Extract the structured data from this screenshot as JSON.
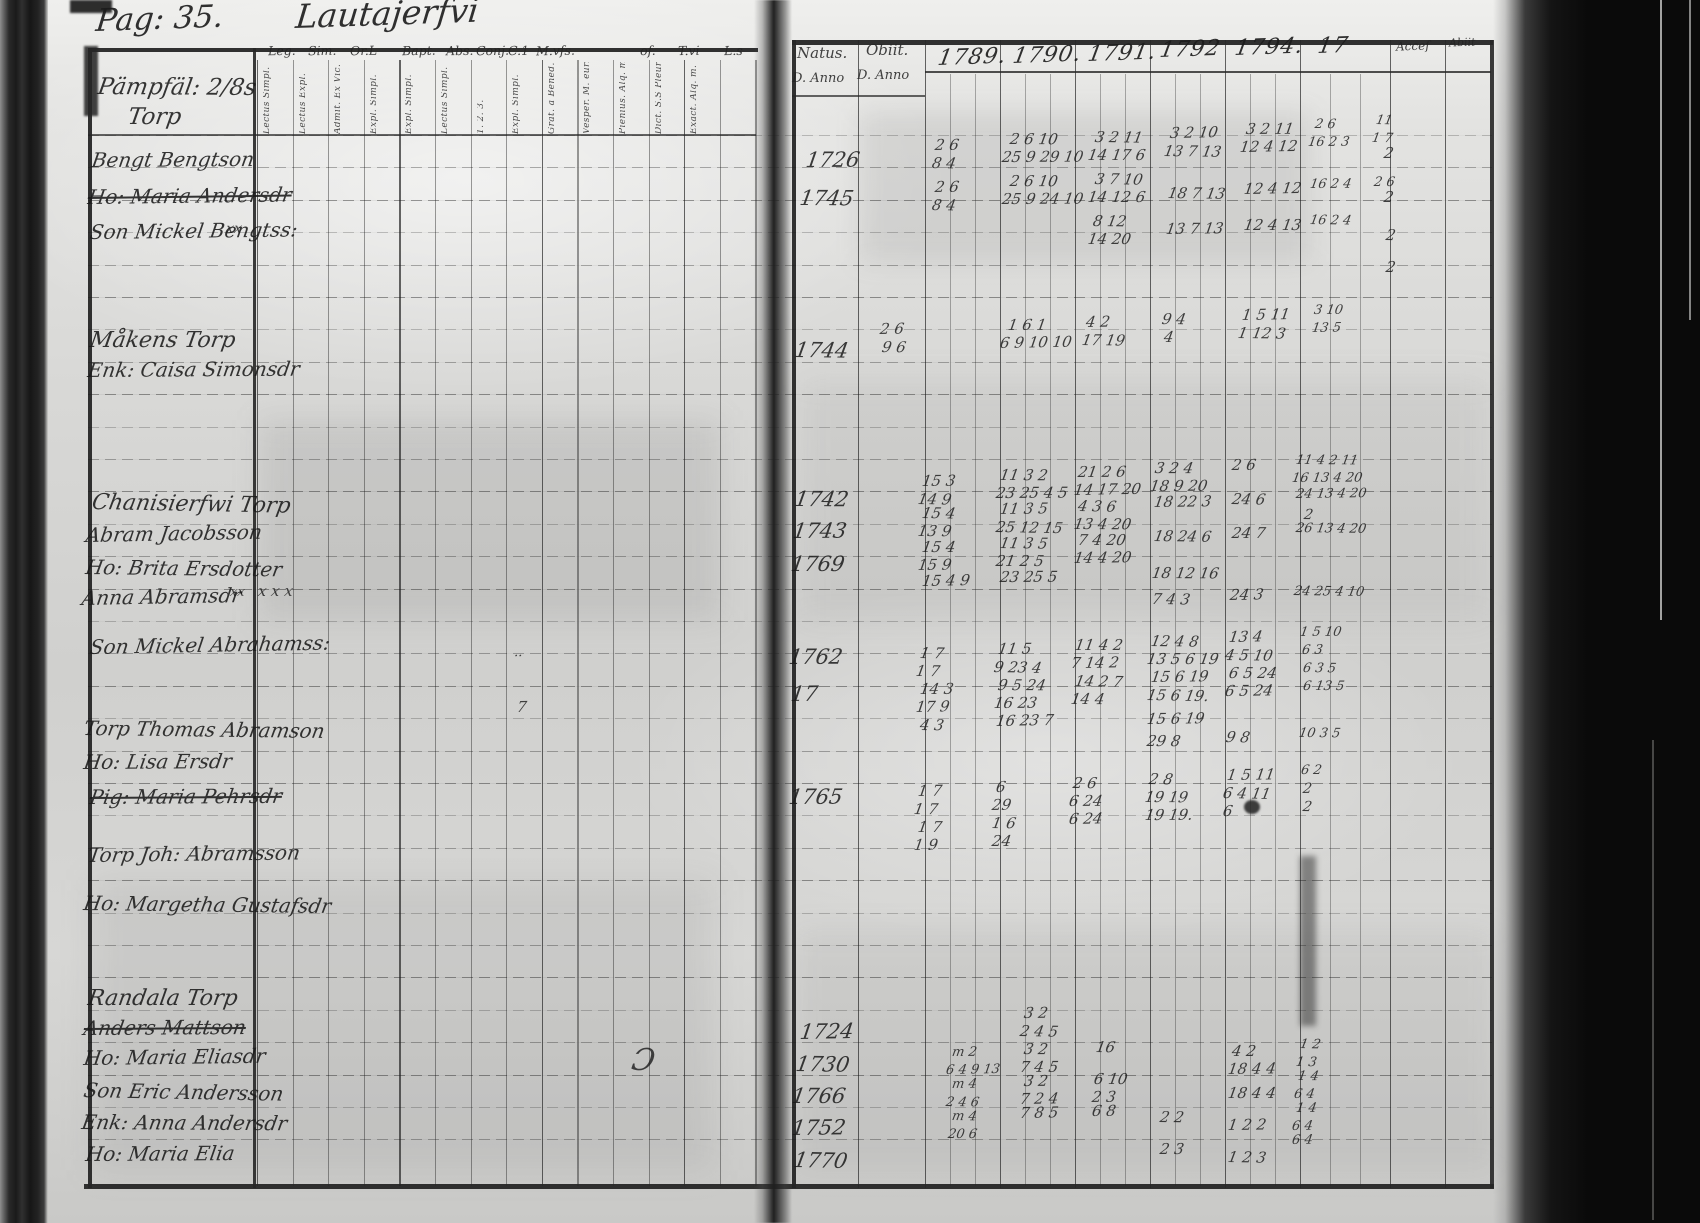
{
  "titles": {
    "page_label": "Pag: 35.",
    "book_title": "Lautajerfvi"
  },
  "ink_color": "#1b1b1b",
  "left_page": {
    "column_groups": [
      {
        "label": "Leg.",
        "x": 268
      },
      {
        "label": "Sim.",
        "x": 308
      },
      {
        "label": "Or.L",
        "x": 350
      },
      {
        "label": "Bapt.",
        "x": 402
      },
      {
        "label": "Abs.",
        "x": 446
      },
      {
        "label": "Conj.",
        "x": 476
      },
      {
        "label": "C.1",
        "x": 508
      },
      {
        "label": "M.vfs.",
        "x": 536
      },
      {
        "label": "of.",
        "x": 640
      },
      {
        "label": "T.vi",
        "x": 678
      },
      {
        "label": "L.s",
        "x": 724
      }
    ],
    "column_subheaders": [
      "Lectus Simpl.",
      "Lectus Expl.",
      "Admit. Ex Vic.",
      "Expl. Simpl.",
      "Expl. Simpl.",
      "Lectus Simpl.",
      "1. 2. 3.",
      "Expl. Simpl.",
      "Grat. a Bened.",
      "Vesper. M. eur.",
      "Pienius. Alq. m.",
      "Dict. S.S Pleuris.",
      "Exact. Alq. m.",
      ""
    ],
    "entries": [
      {
        "text": "Pämpfäl: 2/8s",
        "x": 98,
        "y": 76,
        "size": 23
      },
      {
        "text": "Torp",
        "x": 128,
        "y": 106,
        "size": 23
      },
      {
        "text": "Bengt Bengtson",
        "x": 92,
        "y": 150,
        "size": 20
      },
      {
        "text": "Ho: Maria Andersdr",
        "x": 88,
        "y": 187,
        "size": 20,
        "struck": true
      },
      {
        "text": "Son Mickel Bengtss:",
        "x": 90,
        "y": 222,
        "size": 20
      },
      {
        "text": "Måkens Torp",
        "x": 90,
        "y": 330,
        "size": 22
      },
      {
        "text": "Enk: Caisa Simonsdr",
        "x": 88,
        "y": 360,
        "size": 20
      },
      {
        "text": "Chanisierfwi Torp",
        "x": 92,
        "y": 492,
        "size": 22
      },
      {
        "text": "Abram Jacobsson",
        "x": 86,
        "y": 525,
        "size": 20
      },
      {
        "text": "Ho: Brita Ersdotter",
        "x": 86,
        "y": 557,
        "size": 20
      },
      {
        "text": "Anna Abramsdr",
        "x": 82,
        "y": 588,
        "size": 20
      },
      {
        "text": "Son Mickel Abrahamss:",
        "x": 90,
        "y": 637,
        "size": 20
      },
      {
        "text": "Torp Thomas Abramson",
        "x": 84,
        "y": 718,
        "size": 20
      },
      {
        "text": "Ho: Lisa Ersdr",
        "x": 84,
        "y": 752,
        "size": 20
      },
      {
        "text": "Pig: Maria Pehrsdr",
        "x": 90,
        "y": 787,
        "size": 20,
        "struck": true
      },
      {
        "text": "Torp Joh: Abramsson",
        "x": 88,
        "y": 845,
        "size": 20
      },
      {
        "text": "Ho: Margetha Gustafsdr",
        "x": 84,
        "y": 893,
        "size": 20
      },
      {
        "text": "Randala Torp",
        "x": 88,
        "y": 988,
        "size": 22
      },
      {
        "text": "Anders Mattson",
        "x": 84,
        "y": 1018,
        "size": 20,
        "struck": true
      },
      {
        "text": "Ho: Maria Eliasdr",
        "x": 84,
        "y": 1048,
        "size": 20
      },
      {
        "text": "Son Eric Andersson",
        "x": 84,
        "y": 1080,
        "size": 20
      },
      {
        "text": "Enk: Anna Andersdr",
        "x": 82,
        "y": 1112,
        "size": 20
      },
      {
        "text": "Ho: Maria Elia",
        "x": 86,
        "y": 1144,
        "size": 20
      }
    ],
    "misc_marks": [
      [
        226,
        222,
        "xx",
        14
      ],
      [
        230,
        586,
        "xx",
        13
      ],
      [
        258,
        584,
        "x x x",
        15
      ],
      [
        514,
        650,
        "··",
        13
      ],
      [
        517,
        700,
        "7",
        15
      ],
      [
        632,
        1046,
        "Ɔ",
        30
      ]
    ]
  },
  "right_page": {
    "natus_label": "Natus.",
    "obiit_label": "Obiit.",
    "anno_label": "D. Anno",
    "anno_label2": "D. Anno",
    "accessit_label": "Acceſ",
    "abiit_label": "Abiit",
    "year_headers": [
      {
        "label": "1789.",
        "x": 938,
        "y": 48
      },
      {
        "label": "1790.",
        "x": 1013,
        "y": 46
      },
      {
        "label": "1791.",
        "x": 1088,
        "y": 44
      },
      {
        "label": "1792",
        "x": 1160,
        "y": 40
      },
      {
        "label": "1794.",
        "x": 1235,
        "y": 38
      },
      {
        "label": "17",
        "x": 1318,
        "y": 36
      }
    ],
    "natus_years": [
      [
        806,
        150,
        "1726"
      ],
      [
        800,
        188,
        "1745"
      ],
      [
        795,
        340,
        "1744"
      ],
      [
        795,
        489,
        "1742"
      ],
      [
        793,
        521,
        "1743"
      ],
      [
        791,
        554,
        "1769"
      ],
      [
        789,
        647,
        "1762"
      ],
      [
        791,
        684,
        "17"
      ],
      [
        789,
        787,
        "1765"
      ],
      [
        800,
        1022,
        "1724"
      ],
      [
        796,
        1054,
        "1730"
      ],
      [
        792,
        1086,
        "1766"
      ],
      [
        792,
        1118,
        "1752"
      ],
      [
        794,
        1150,
        "1770"
      ]
    ],
    "ink_marks": [
      [
        935,
        138,
        "2 6"
      ],
      [
        932,
        156,
        "8 4"
      ],
      [
        1010,
        132,
        "2 6 10"
      ],
      [
        1002,
        150,
        "25 9 29 10"
      ],
      [
        1095,
        130,
        "3 2 11"
      ],
      [
        1088,
        148,
        "14 17 6"
      ],
      [
        1170,
        126,
        "3 2 10"
      ],
      [
        1164,
        144,
        "13 7 13"
      ],
      [
        1246,
        122,
        "3 2 11"
      ],
      [
        1240,
        140,
        "12 4 12"
      ],
      [
        1315,
        118,
        "2 6",
        13
      ],
      [
        1308,
        136,
        "16 2 3",
        13
      ],
      [
        1376,
        114,
        "11",
        13
      ],
      [
        1372,
        132,
        "1 7",
        13
      ],
      [
        935,
        180,
        "2 6"
      ],
      [
        932,
        198,
        "8 4"
      ],
      [
        1010,
        174,
        "2 6 10"
      ],
      [
        1002,
        192,
        "25 9 24 10"
      ],
      [
        1095,
        172,
        "3 7 10"
      ],
      [
        1088,
        190,
        "14 12 6"
      ],
      [
        1168,
        186,
        "18 7 13"
      ],
      [
        1244,
        182,
        "12 4 12"
      ],
      [
        1310,
        178,
        "16 2 4",
        13
      ],
      [
        1374,
        176,
        "2 6",
        13
      ],
      [
        1093,
        214,
        "8 12"
      ],
      [
        1088,
        232,
        "14 20"
      ],
      [
        1166,
        222,
        "13 7 13"
      ],
      [
        1244,
        218,
        "12 4 13"
      ],
      [
        1310,
        214,
        "16 2 4",
        13
      ],
      [
        1384,
        146,
        "2",
        15
      ],
      [
        1384,
        190,
        "2",
        15
      ],
      [
        1386,
        228,
        "2",
        15
      ],
      [
        1386,
        260,
        "2",
        15
      ],
      [
        880,
        322,
        "2 6"
      ],
      [
        882,
        340,
        "9 6"
      ],
      [
        1008,
        318,
        "1 6 1"
      ],
      [
        1000,
        336,
        "6 9 10 10"
      ],
      [
        1086,
        315,
        "4 2"
      ],
      [
        1082,
        333,
        "17 19"
      ],
      [
        1162,
        312,
        "9 4"
      ],
      [
        1164,
        330,
        "4"
      ],
      [
        1242,
        308,
        "1 5 11"
      ],
      [
        1238,
        326,
        "1 12 3"
      ],
      [
        1314,
        304,
        "3 10",
        13
      ],
      [
        1312,
        322,
        "13 5",
        13
      ],
      [
        922,
        474,
        "15 3"
      ],
      [
        918,
        492,
        "14 9"
      ],
      [
        1000,
        468,
        "11 3 2"
      ],
      [
        996,
        486,
        "23 25 4 5"
      ],
      [
        1078,
        465,
        "21 2 6"
      ],
      [
        1074,
        483,
        "14 17 20"
      ],
      [
        1155,
        461,
        "3 2 4"
      ],
      [
        1150,
        479,
        "18 9 20"
      ],
      [
        1232,
        458,
        "2 6"
      ],
      [
        1296,
        454,
        "11 4 2 11",
        13
      ],
      [
        1292,
        472,
        "16 13 4 20",
        13
      ],
      [
        922,
        506,
        "15 4"
      ],
      [
        918,
        524,
        "13 9"
      ],
      [
        1000,
        502,
        "11 3 5"
      ],
      [
        996,
        520,
        "25 12 15"
      ],
      [
        1078,
        499,
        "4 3 6"
      ],
      [
        1074,
        517,
        "13 4 20"
      ],
      [
        1154,
        495,
        "18 22 3"
      ],
      [
        1232,
        492,
        "24 6"
      ],
      [
        1296,
        488,
        "24 13 4 20",
        13
      ],
      [
        1304,
        508,
        "2",
        14
      ],
      [
        922,
        540,
        "15 4"
      ],
      [
        918,
        558,
        "15 9"
      ],
      [
        1000,
        536,
        "11 3 5"
      ],
      [
        996,
        554,
        "21 2 5"
      ],
      [
        1078,
        533,
        "7 4 20"
      ],
      [
        1074,
        551,
        "14 4 20"
      ],
      [
        1154,
        529,
        "18 24 6"
      ],
      [
        1232,
        526,
        "24 7"
      ],
      [
        1296,
        522,
        "26 13 4 20",
        13
      ],
      [
        922,
        574,
        "15 4 9"
      ],
      [
        1000,
        570,
        "23 25 5"
      ],
      [
        1152,
        566,
        "18 12 16"
      ],
      [
        1152,
        592,
        "7 4 3"
      ],
      [
        1230,
        588,
        "24 3"
      ],
      [
        1294,
        585,
        "24 25 4 10",
        13
      ],
      [
        920,
        646,
        "1 7"
      ],
      [
        916,
        664,
        "1 7"
      ],
      [
        998,
        642,
        "11 5"
      ],
      [
        994,
        660,
        "9 23 4"
      ],
      [
        1075,
        638,
        "11 4 2"
      ],
      [
        1071,
        656,
        "7 14 2"
      ],
      [
        1151,
        634,
        "12 4 8"
      ],
      [
        1147,
        652,
        "13 5 6 19"
      ],
      [
        1229,
        630,
        "13 4"
      ],
      [
        1225,
        648,
        "4 5 10"
      ],
      [
        1300,
        626,
        "1 5 10",
        13
      ],
      [
        1302,
        644,
        "6 3",
        13
      ],
      [
        920,
        682,
        "14 3"
      ],
      [
        916,
        700,
        "17 9"
      ],
      [
        998,
        678,
        "9 5 24"
      ],
      [
        994,
        696,
        "16 23"
      ],
      [
        1075,
        674,
        "14 2 7"
      ],
      [
        1071,
        692,
        "14 4"
      ],
      [
        1151,
        670,
        "15 6 19"
      ],
      [
        1147,
        688,
        "15 6 19."
      ],
      [
        1229,
        666,
        "6 5 24"
      ],
      [
        1225,
        684,
        "6 5 24"
      ],
      [
        1303,
        662,
        "6 3 5",
        13
      ],
      [
        1303,
        680,
        "6 13 5",
        13
      ],
      [
        920,
        718,
        "4 3"
      ],
      [
        996,
        714,
        "16 23 7"
      ],
      [
        1147,
        712,
        "15 6 19"
      ],
      [
        1147,
        734,
        "29 8"
      ],
      [
        1226,
        730,
        "9 8"
      ],
      [
        1299,
        727,
        "10 3 5",
        13
      ],
      [
        918,
        784,
        "1 7"
      ],
      [
        914,
        802,
        "1 7"
      ],
      [
        996,
        780,
        "6"
      ],
      [
        992,
        798,
        "29"
      ],
      [
        1073,
        776,
        "2 6"
      ],
      [
        1069,
        794,
        "6 24"
      ],
      [
        1149,
        772,
        "2 8"
      ],
      [
        1145,
        790,
        "19 19"
      ],
      [
        1227,
        768,
        "1 5 11"
      ],
      [
        1223,
        786,
        "6 4 11"
      ],
      [
        1301,
        764,
        "6 2",
        13
      ],
      [
        1303,
        782,
        "2",
        14
      ],
      [
        918,
        820,
        "1 7"
      ],
      [
        992,
        816,
        "1 6"
      ],
      [
        1069,
        812,
        "6 24"
      ],
      [
        1145,
        808,
        "19 19."
      ],
      [
        1223,
        804,
        "6"
      ],
      [
        1303,
        800,
        "2",
        14
      ],
      [
        914,
        838,
        "1 9"
      ],
      [
        992,
        834,
        "24"
      ],
      [
        1024,
        1006,
        "3 2"
      ],
      [
        1020,
        1024,
        "2 4 5"
      ],
      [
        952,
        1046,
        "m 2",
        13
      ],
      [
        946,
        1064,
        "6 4 9 13",
        13
      ],
      [
        1024,
        1042,
        "3 2"
      ],
      [
        1020,
        1060,
        "7 4 5"
      ],
      [
        1096,
        1040,
        "16"
      ],
      [
        1232,
        1044,
        "4 2"
      ],
      [
        1228,
        1062,
        "18 4 4"
      ],
      [
        1300,
        1038,
        "1 2",
        13
      ],
      [
        1296,
        1056,
        "1 3",
        13
      ],
      [
        952,
        1078,
        "m 4",
        13
      ],
      [
        946,
        1096,
        "2 4 6",
        13
      ],
      [
        1024,
        1074,
        "3 2"
      ],
      [
        1020,
        1092,
        "7 2 4"
      ],
      [
        1094,
        1072,
        "6 10"
      ],
      [
        1092,
        1090,
        "2 3"
      ],
      [
        1228,
        1086,
        "18 4 4"
      ],
      [
        1298,
        1070,
        "1 4",
        13
      ],
      [
        1294,
        1088,
        "6 4",
        13
      ],
      [
        952,
        1110,
        "m 4",
        13
      ],
      [
        948,
        1128,
        "20 6",
        13
      ],
      [
        1020,
        1106,
        "7 8 5"
      ],
      [
        1092,
        1104,
        "6 8"
      ],
      [
        1160,
        1110,
        "2 2"
      ],
      [
        1228,
        1118,
        "1 2 2"
      ],
      [
        1296,
        1102,
        "1 4",
        13
      ],
      [
        1292,
        1120,
        "6 4",
        13
      ],
      [
        1160,
        1142,
        "2 3"
      ],
      [
        1228,
        1150,
        "1 2 3"
      ],
      [
        1292,
        1134,
        "6 4",
        13
      ]
    ]
  }
}
